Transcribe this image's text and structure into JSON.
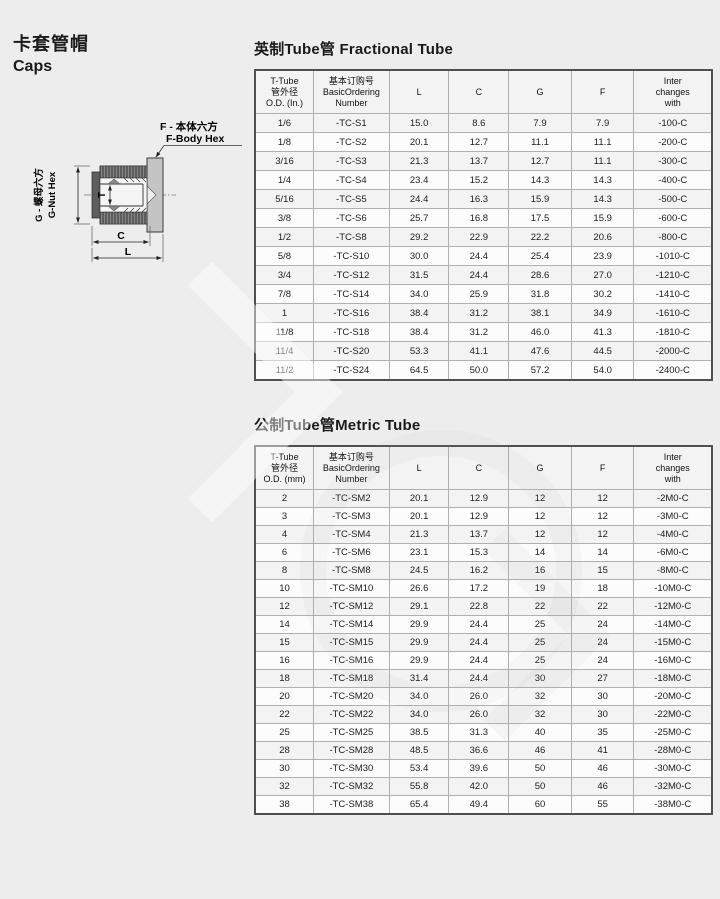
{
  "page": {
    "title_zh": "卡套管帽",
    "title_en": "Caps"
  },
  "diagram": {
    "f_label_zh": "F - 本体六方",
    "f_label_en": "F-Body Hex",
    "g_label_zh": "G - 螺母六方",
    "g_label_en": "G-Nut Hex",
    "dim_t": "T",
    "dim_c": "C",
    "dim_l": "L"
  },
  "fractional_table": {
    "title": "英制Tube管 Fractional Tube",
    "headers": [
      [
        "T-Tube",
        "管外径",
        "O.D. (In.)"
      ],
      [
        "基本订购号",
        "BasicOrdering",
        "Number"
      ],
      [
        "L"
      ],
      [
        "C"
      ],
      [
        "G"
      ],
      [
        "F"
      ],
      [
        "Inter",
        "changes",
        "with"
      ]
    ],
    "rows": [
      [
        "1/6",
        "-TC-S1",
        "15.0",
        "8.6",
        "7.9",
        "7.9",
        "-100-C"
      ],
      [
        "1/8",
        "-TC-S2",
        "20.1",
        "12.7",
        "11.1",
        "11.1",
        "-200-C"
      ],
      [
        "3/16",
        "-TC-S3",
        "21.3",
        "13.7",
        "12.7",
        "11.1",
        "-300-C"
      ],
      [
        "1/4",
        "-TC-S4",
        "23.4",
        "15.2",
        "14.3",
        "14.3",
        "-400-C"
      ],
      [
        "5/16",
        "-TC-S5",
        "24.4",
        "16.3",
        "15.9",
        "14.3",
        "-500-C"
      ],
      [
        "3/8",
        "-TC-S6",
        "25.7",
        "16.8",
        "17.5",
        "15.9",
        "-600-C"
      ],
      [
        "1/2",
        "-TC-S8",
        "29.2",
        "22.9",
        "22.2",
        "20.6",
        "-800-C"
      ],
      [
        "5/8",
        "-TC-S10",
        "30.0",
        "24.4",
        "25.4",
        "23.9",
        "-1010-C"
      ],
      [
        "3/4",
        "-TC-S12",
        "31.5",
        "24.4",
        "28.6",
        "27.0",
        "-1210-C"
      ],
      [
        "7/8",
        "-TC-S14",
        "34.0",
        "25.9",
        "31.8",
        "30.2",
        "-1410-C"
      ],
      [
        "1",
        "-TC-S16",
        "38.4",
        "31.2",
        "38.1",
        "34.9",
        "-1610-C"
      ],
      [
        "11/8",
        "-TC-S18",
        "38.4",
        "31.2",
        "46.0",
        "41.3",
        "-1810-C"
      ],
      [
        "11/4",
        "-TC-S20",
        "53.3",
        "41.1",
        "47.6",
        "44.5",
        "-2000-C"
      ],
      [
        "11/2",
        "-TC-S24",
        "64.5",
        "50.0",
        "57.2",
        "54.0",
        "-2400-C"
      ]
    ]
  },
  "metric_table": {
    "title": "公制Tube管Metric Tube",
    "headers": [
      [
        "T-Tube",
        "管外径",
        "O.D. (mm)"
      ],
      [
        "基本订购号",
        "BasicOrdering",
        "Number"
      ],
      [
        "L"
      ],
      [
        "C"
      ],
      [
        "G"
      ],
      [
        "F"
      ],
      [
        "Inter",
        "changes",
        "with"
      ]
    ],
    "rows": [
      [
        "2",
        "-TC-SM2",
        "20.1",
        "12.9",
        "12",
        "12",
        "-2M0-C"
      ],
      [
        "3",
        "-TC-SM3",
        "20.1",
        "12.9",
        "12",
        "12",
        "-3M0-C"
      ],
      [
        "4",
        "-TC-SM4",
        "21.3",
        "13.7",
        "12",
        "12",
        "-4M0-C"
      ],
      [
        "6",
        "-TC-SM6",
        "23.1",
        "15.3",
        "14",
        "14",
        "-6M0-C"
      ],
      [
        "8",
        "-TC-SM8",
        "24.5",
        "16.2",
        "16",
        "15",
        "-8M0-C"
      ],
      [
        "10",
        "-TC-SM10",
        "26.6",
        "17.2",
        "19",
        "18",
        "-10M0-C"
      ],
      [
        "12",
        "-TC-SM12",
        "29.1",
        "22.8",
        "22",
        "22",
        "-12M0-C"
      ],
      [
        "14",
        "-TC-SM14",
        "29.9",
        "24.4",
        "25",
        "24",
        "-14M0-C"
      ],
      [
        "15",
        "-TC-SM15",
        "29.9",
        "24.4",
        "25",
        "24",
        "-15M0-C"
      ],
      [
        "16",
        "-TC-SM16",
        "29.9",
        "24.4",
        "25",
        "24",
        "-16M0-C"
      ],
      [
        "18",
        "-TC-SM18",
        "31.4",
        "24.4",
        "30",
        "27",
        "-18M0-C"
      ],
      [
        "20",
        "-TC-SM20",
        "34.0",
        "26.0",
        "32",
        "30",
        "-20M0-C"
      ],
      [
        "22",
        "-TC-SM22",
        "34.0",
        "26.0",
        "32",
        "30",
        "-22M0-C"
      ],
      [
        "25",
        "-TC-SM25",
        "38.5",
        "31.3",
        "40",
        "35",
        "-25M0-C"
      ],
      [
        "28",
        "-TC-SM28",
        "48.5",
        "36.6",
        "46",
        "41",
        "-28M0-C"
      ],
      [
        "30",
        "-TC-SM30",
        "53.4",
        "39.6",
        "50",
        "46",
        "-30M0-C"
      ],
      [
        "32",
        "-TC-SM32",
        "55.8",
        "42.0",
        "50",
        "46",
        "-32M0-C"
      ],
      [
        "38",
        "-TC-SM38",
        "65.4",
        "49.4",
        "60",
        "55",
        "-38M0-C"
      ]
    ]
  },
  "colors": {
    "page_bg": "#ededed",
    "table_outer_border": "#4f4f4f",
    "table_grid": "#b0b0b0",
    "nut_fill": "#5d5d5d",
    "body_fill": "#c4c4c4"
  }
}
